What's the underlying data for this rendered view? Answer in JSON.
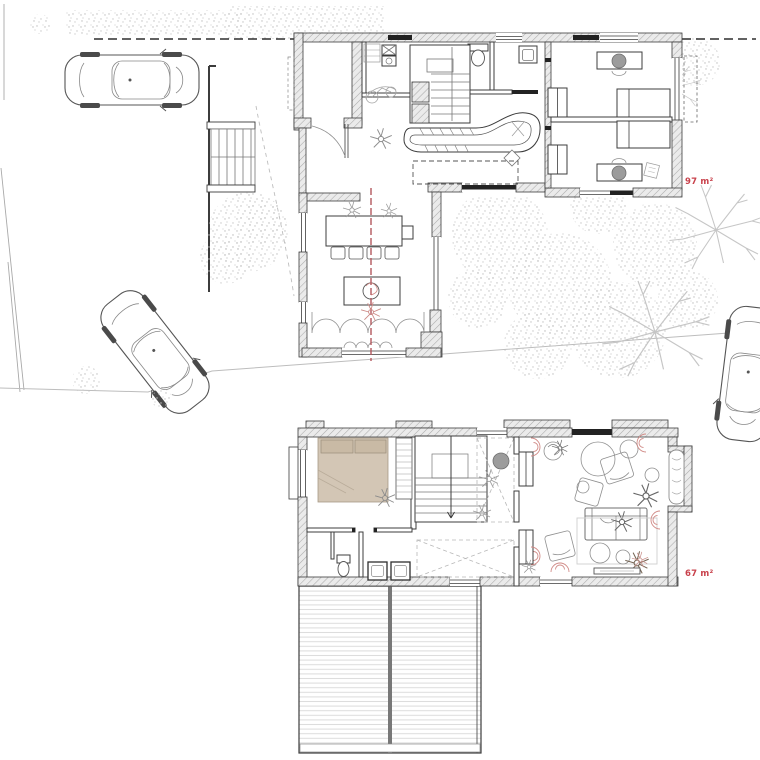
{
  "plans": {
    "ground": {
      "name": "ground-floor-site-plan",
      "area_label": "97 m²"
    },
    "upper": {
      "name": "upper-floor-plan",
      "area_label": "67 m²"
    }
  },
  "colors": {
    "area_label_red": "#c8414b",
    "section_line_red": "#b3595e",
    "soft_red_accent": "#d08a86",
    "bed_beige": "#d3c6b5",
    "pillow_beige": "#c9baa5",
    "chair_gray": "#9c9c9c",
    "line_dark": "#3c3c3c",
    "sketch_gray": "#8f8f8f",
    "hatch_gray": "#ababab",
    "stipple_gray": "#bdbdbd",
    "deck_line_gray": "#dcdcdc",
    "background": "#ffffff"
  },
  "icons": {
    "elements": [
      "car-icon",
      "tree-stipple-icon",
      "bare-tree-icon",
      "exterior-stairs",
      "staircase",
      "bed",
      "desk",
      "desk-chair",
      "wardrobe",
      "dining-table",
      "dining-chairs",
      "kitchen-counter",
      "island",
      "toilet",
      "sink",
      "washer",
      "sofa",
      "armchair",
      "rug",
      "pouf",
      "plant-icon",
      "lounge-chair",
      "terrace-deck",
      "section-line",
      "property-line"
    ]
  }
}
